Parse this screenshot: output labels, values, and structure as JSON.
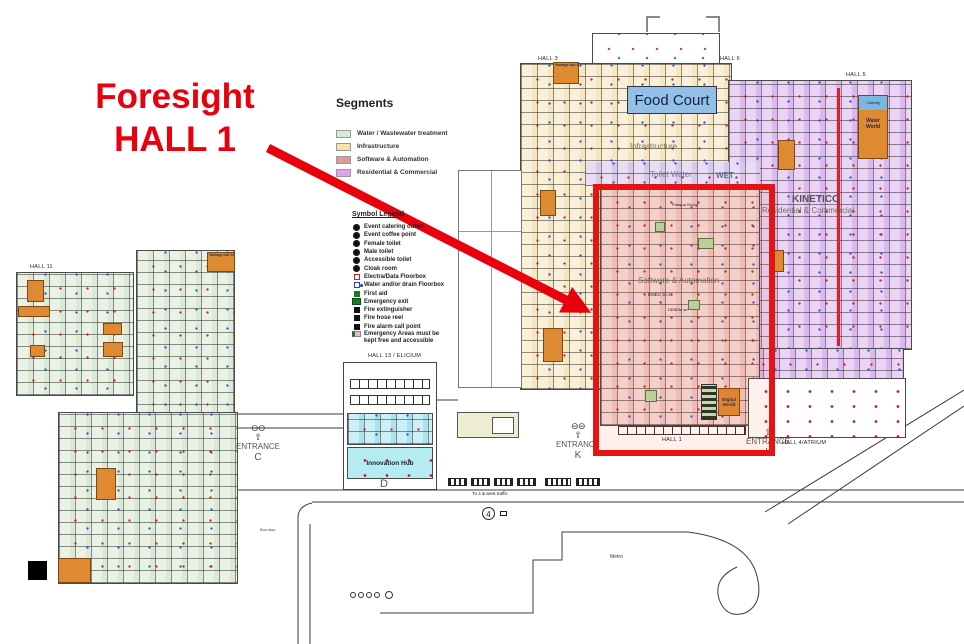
{
  "annotation": {
    "line1": "Foresight",
    "line2": "HALL 1",
    "color": "#e8000d"
  },
  "segments_legend": {
    "title": "Segments",
    "items": [
      {
        "label": "Water / Wastewater treatment",
        "color": "#d9ead3"
      },
      {
        "label": "Infrastructure",
        "color": "#fae3a4"
      },
      {
        "label": "Software & Automation",
        "color": "#dc9a9a"
      },
      {
        "label": "Residential & Commercial",
        "color": "#d9a6ea"
      }
    ]
  },
  "symbol_legend": {
    "title": "Symbol Legend",
    "items": [
      {
        "label": "Event catering outlet",
        "icon": "catering-point-icon"
      },
      {
        "label": "Event coffee point",
        "icon": "coffee-point-icon"
      },
      {
        "label": "Female toilet",
        "icon": "female-toilet-icon"
      },
      {
        "label": "Male toilet",
        "icon": "male-toilet-icon"
      },
      {
        "label": "Accessible toilet",
        "icon": "accessible-toilet-icon"
      },
      {
        "label": "Cloak room",
        "icon": "cloak-room-icon"
      },
      {
        "label": "Electra/Data Floorbox",
        "icon": "electra-floorbox-icon"
      },
      {
        "label": "Water and/or drain Floorbox",
        "icon": "water-floorbox-icon"
      },
      {
        "label": "First aid",
        "icon": "first-aid-icon"
      },
      {
        "label": "Emergency exit",
        "icon": "emergency-exit-icon"
      },
      {
        "label": "Fire extinguisher",
        "icon": "fire-extinguisher-icon"
      },
      {
        "label": "Fire hose reel",
        "icon": "fire-hose-icon"
      },
      {
        "label": "Fire alarm call point",
        "icon": "fire-alarm-icon"
      },
      {
        "label": "Emergency Areas must be kept free and accessible",
        "icon": "emergency-area-icon"
      }
    ]
  },
  "halls": {
    "hall3": "HALL 3",
    "hall6": "HALL 6",
    "hall5": "HALL 5",
    "hall11": "HALL 11",
    "hall13": "HALL 13 / ELICIUM",
    "hall1": "HALL 1",
    "hall4": "HALL 4/ATRIUM"
  },
  "landmarks": {
    "food_court": "Food Court",
    "innovation_hub": "Innovation Hub",
    "digital_world": "Digital World",
    "water_world": "Water World",
    "catering": "Catering",
    "kinetico": "KINETICO",
    "vantage_hall_3": "Vantage hall 3",
    "vantage_hall_10": "Vantage hall 10",
    "pdaqua_group": "Pdaqua Group",
    "emec": "EMEC S.r.l.",
    "debem": "DEBEM srl",
    "wet": "WET",
    "toilet_water": "Toilet Water"
  },
  "watermarks": {
    "infrastructure": "Infrastructure",
    "software": "Software & Automation",
    "residential": "Residential & Commercial"
  },
  "entrances": {
    "c": {
      "label": "ENTRANCE",
      "letter": "C"
    },
    "k": {
      "label": "ENTRANCE",
      "letter": "K"
    },
    "l": {
      "label": "ENTRANCE",
      "letter": "L"
    }
  },
  "icons": {
    "turnstiles": "⊖⊖",
    "up_arrow": "⇧"
  },
  "roads": {
    "metro": "Metro",
    "traffic_note": "To 4 & west traffic",
    "route_number": "4",
    "d_label": "D",
    "bus_stop": "Bus stop"
  }
}
